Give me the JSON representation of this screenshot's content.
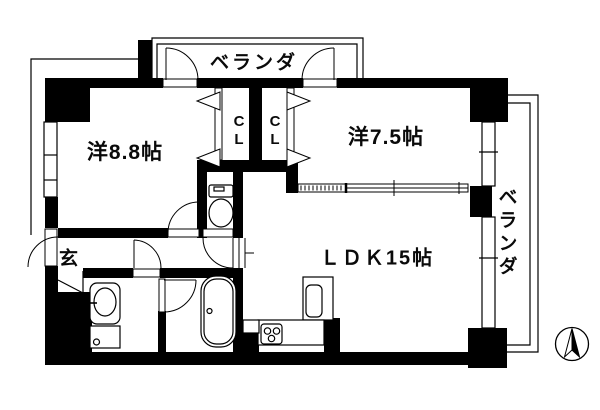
{
  "labels": {
    "room_west_1": "洋8.8帖",
    "room_west_2": "洋7.5帖",
    "ldk": "ＬＤＫ15帖",
    "entrance": "玄",
    "closet_left": "CL",
    "closet_right": "CL",
    "balcony_top": "ベランダ",
    "balcony_right": "ベランダ"
  },
  "colors": {
    "line": "#000000",
    "background": "#ffffff"
  },
  "compass": {
    "points": "N"
  }
}
